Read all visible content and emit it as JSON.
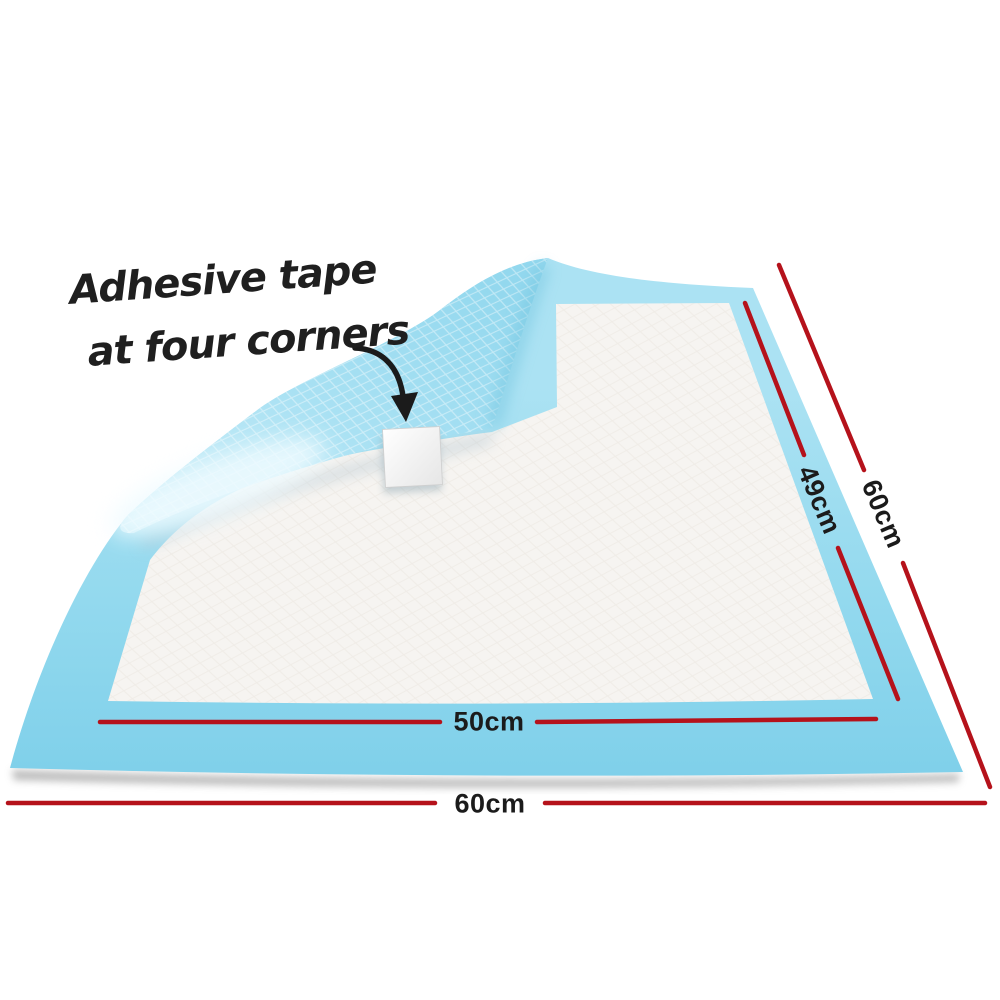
{
  "annotation": {
    "line1": "Adhesive tape",
    "line2": "at four corners"
  },
  "dimensions": {
    "inner_bottom_width": "50cm",
    "outer_bottom_width": "60cm",
    "inner_right_length": "49cm",
    "outer_right_length": "60cm"
  },
  "colors": {
    "dimension_line": "#b5121b",
    "pad_border_blue": "#86d3ec",
    "pad_back_blue": "#a9e1f3",
    "pad_core_white": "#f6f4f1",
    "text": "#1b1b1b"
  }
}
